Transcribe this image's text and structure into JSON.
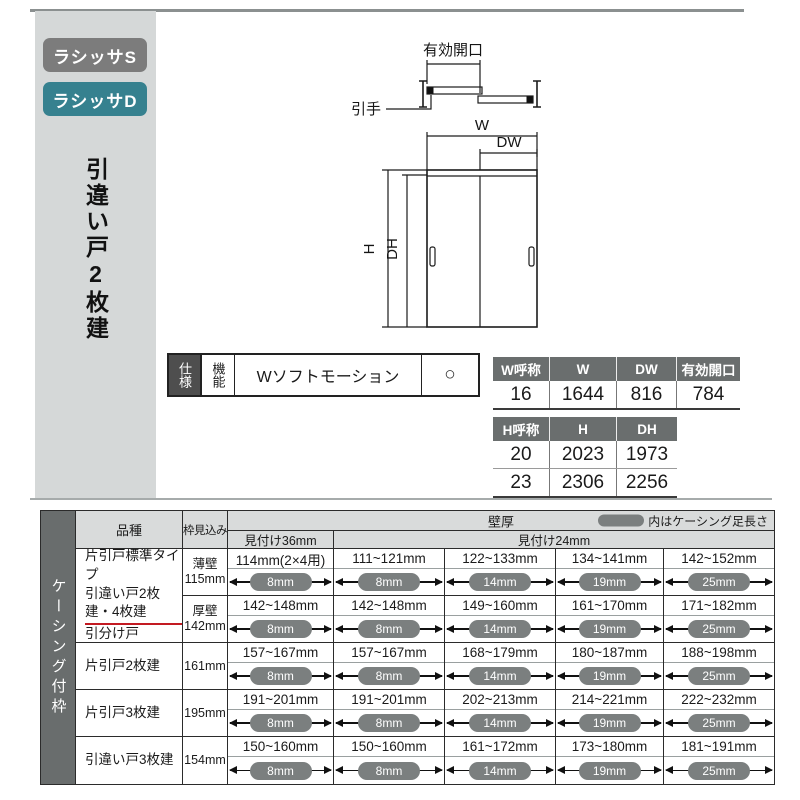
{
  "sidebar": {
    "badge_s": "ラシッサS",
    "badge_d": "ラシッサD",
    "title": "引違い戸2枚建"
  },
  "diagram": {
    "labels": {
      "effective_opening": "有効開口",
      "pull_handle": "引手",
      "w": "W",
      "dw": "DW",
      "h": "H",
      "dh": "DH"
    }
  },
  "spec_table": {
    "row_header": "仕様",
    "col_header": "機能",
    "feature": "Wソフトモーション",
    "availability": "○"
  },
  "w_table": {
    "headers": [
      "W呼称",
      "W",
      "DW",
      "有効開口"
    ],
    "rows": [
      [
        "16",
        "1644",
        "816",
        "784"
      ]
    ]
  },
  "h_table": {
    "headers": [
      "H呼称",
      "H",
      "DH"
    ],
    "rows": [
      [
        "20",
        "2023",
        "1973"
      ],
      [
        "23",
        "2306",
        "2256"
      ]
    ]
  },
  "casing_table": {
    "side_label": "ケーシング付枠",
    "headers": {
      "product": "品種",
      "frame_depth": "枠見込み",
      "wall_thickness": "壁厚",
      "legend_note": "内はケーシング足長さ",
      "mitsuke36": "見付け36mm",
      "mitsuke24": "見付け24mm"
    },
    "groups": [
      {
        "name_line1": "片引戸標準タイプ",
        "name_line2": "引違い戸2枚建・4枚建",
        "name_line3": "引分け戸",
        "subrows": [
          {
            "waku_type": "薄壁",
            "waku_value": "115mm",
            "cells": [
              {
                "range": "114mm(2×4用)",
                "leg": "8mm"
              },
              {
                "range": "111~121mm",
                "leg": "8mm"
              },
              {
                "range": "122~133mm",
                "leg": "14mm"
              },
              {
                "range": "134~141mm",
                "leg": "19mm"
              },
              {
                "range": "142~152mm",
                "leg": "25mm"
              }
            ]
          },
          {
            "waku_type": "厚壁",
            "waku_value": "142mm",
            "cells": [
              {
                "range": "142~148mm",
                "leg": "8mm"
              },
              {
                "range": "142~148mm",
                "leg": "8mm"
              },
              {
                "range": "149~160mm",
                "leg": "14mm"
              },
              {
                "range": "161~170mm",
                "leg": "19mm"
              },
              {
                "range": "171~182mm",
                "leg": "25mm"
              }
            ]
          }
        ]
      },
      {
        "name": "片引戸2枚建",
        "waku": "161mm",
        "cells": [
          {
            "range": "157~167mm",
            "leg": "8mm"
          },
          {
            "range": "157~167mm",
            "leg": "8mm"
          },
          {
            "range": "168~179mm",
            "leg": "14mm"
          },
          {
            "range": "180~187mm",
            "leg": "19mm"
          },
          {
            "range": "188~198mm",
            "leg": "25mm"
          }
        ]
      },
      {
        "name": "片引戸3枚建",
        "waku": "195mm",
        "cells": [
          {
            "range": "191~201mm",
            "leg": "8mm"
          },
          {
            "range": "191~201mm",
            "leg": "8mm"
          },
          {
            "range": "202~213mm",
            "leg": "14mm"
          },
          {
            "range": "214~221mm",
            "leg": "19mm"
          },
          {
            "range": "222~232mm",
            "leg": "25mm"
          }
        ]
      },
      {
        "name": "引違い戸3枚建",
        "waku": "154mm",
        "cells": [
          {
            "range": "150~160mm",
            "leg": "8mm"
          },
          {
            "range": "150~160mm",
            "leg": "8mm"
          },
          {
            "range": "161~172mm",
            "leg": "14mm"
          },
          {
            "range": "173~180mm",
            "leg": "19mm"
          },
          {
            "range": "181~191mm",
            "leg": "25mm"
          }
        ]
      }
    ]
  },
  "colors": {
    "badge_s_bg": "#7c7c7c",
    "badge_d_bg": "#36818f",
    "table_header_bg": "#6a6e6e",
    "casing_pill": "#7b7f7f",
    "red_underline": "#c31a22",
    "sidebar_bg": "#d5d8d8"
  }
}
